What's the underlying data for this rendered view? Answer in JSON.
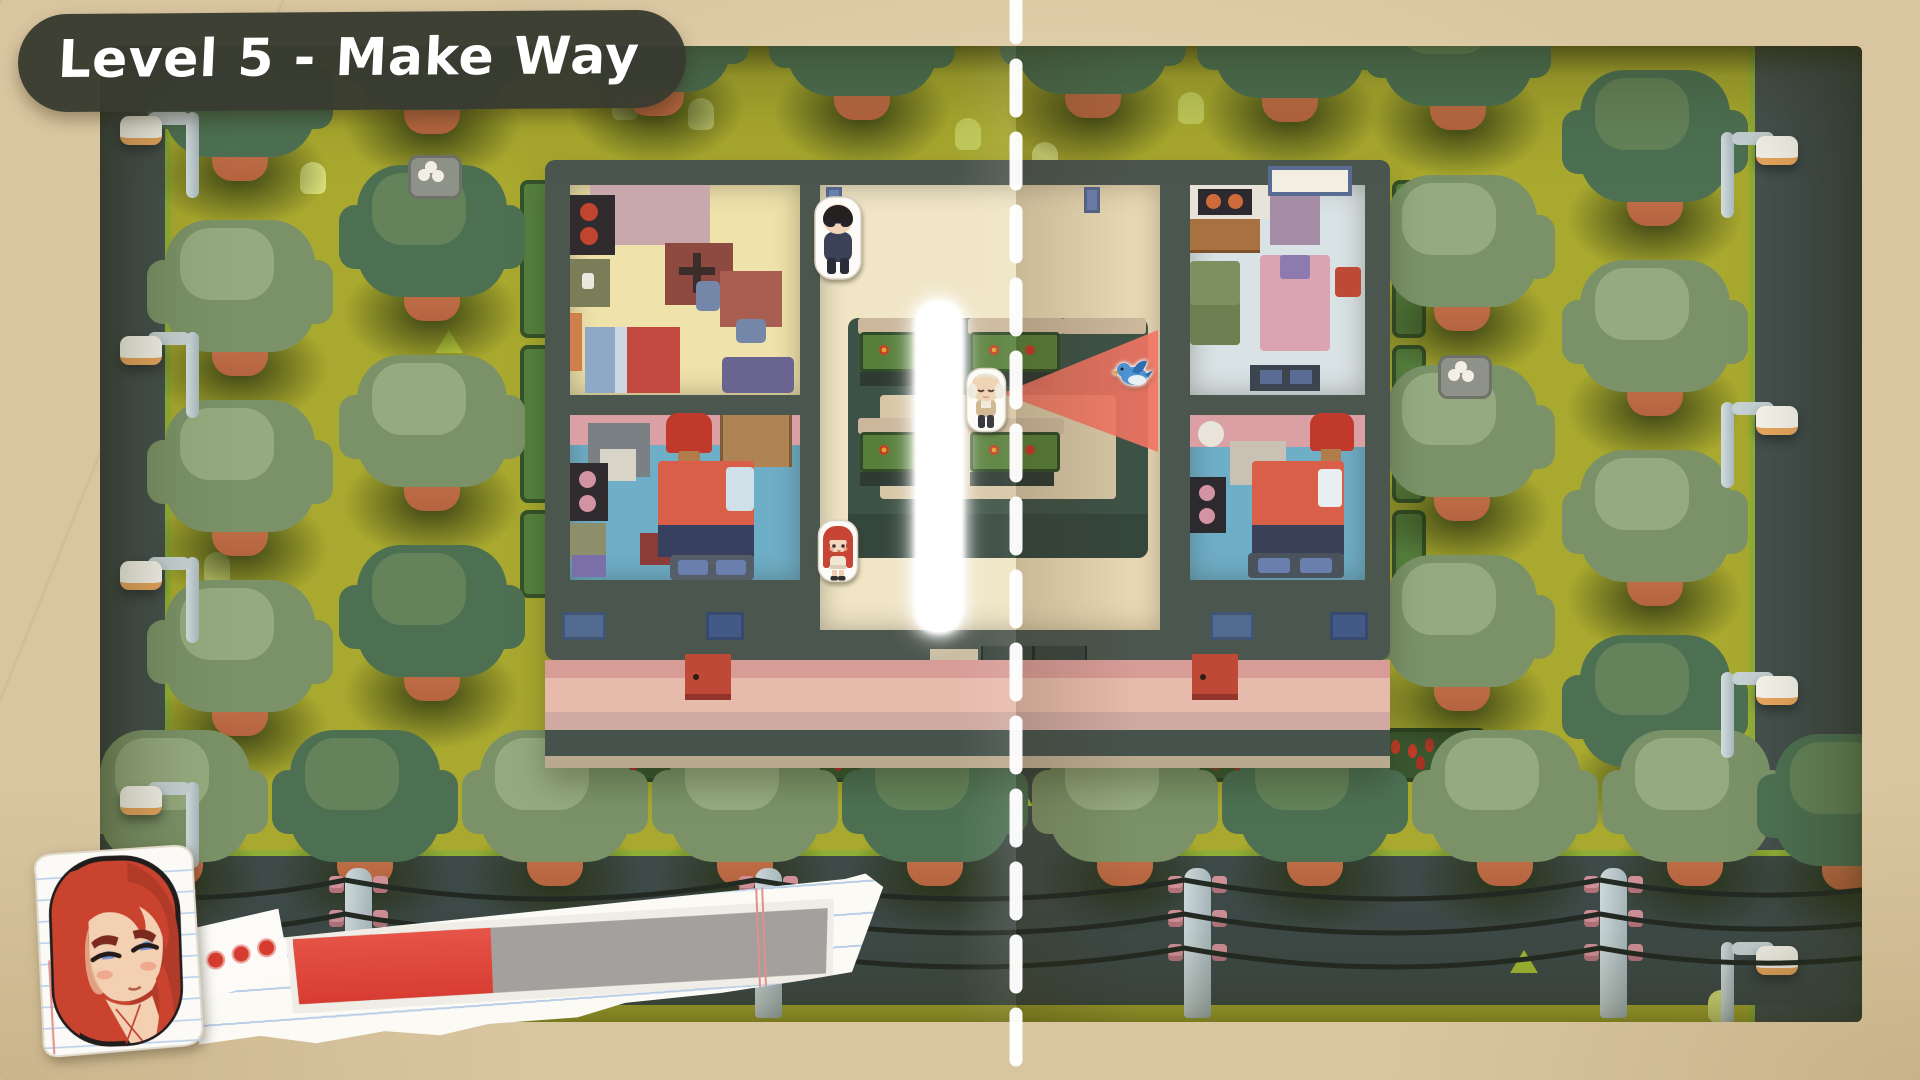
{
  "hud": {
    "level_banner": {
      "label": "Level 5 - Make Way"
    },
    "portrait": {
      "character": "red-haired-girl",
      "style": "notebook-paper-sticker"
    },
    "progress": {
      "percent": 37,
      "fill_color": "#e2463b",
      "track_color": "#a3a09d",
      "pips": 3
    }
  },
  "scene": {
    "fold_line": {
      "x": 1016,
      "color": "#ffffff",
      "style": "dashed-vertical"
    },
    "vision_cone": {
      "owner": "old-man-npc",
      "direction": "right",
      "color": "#f07463"
    },
    "characters": [
      {
        "id": "npc-boy-glasses",
        "x": 712,
        "y": 148
      },
      {
        "id": "npc-old-man",
        "x": 862,
        "y": 316
      },
      {
        "id": "player-red-haired-girl",
        "x": 716,
        "y": 472
      },
      {
        "id": "blue-bird",
        "x": 1012,
        "y": 312
      }
    ],
    "trees": [
      {
        "x": 556,
        "y": -16,
        "v": "dark"
      },
      {
        "x": 762,
        "y": -12,
        "v": "dark"
      },
      {
        "x": 993,
        "y": -14,
        "v": "dark"
      },
      {
        "x": 1190,
        "y": -10,
        "v": "dark"
      },
      {
        "x": 1358,
        "y": -2,
        "v": "dark"
      },
      {
        "x": 140,
        "y": 49,
        "v": "dark"
      },
      {
        "x": 332,
        "y": 2,
        "v": "dark"
      },
      {
        "x": 140,
        "y": 244,
        "v": "sage"
      },
      {
        "x": 140,
        "y": 424,
        "v": "sage"
      },
      {
        "x": 140,
        "y": 604,
        "v": "sage"
      },
      {
        "x": 332,
        "y": 189,
        "v": "dark",
        "nest": true
      },
      {
        "x": 332,
        "y": 379,
        "v": "sage"
      },
      {
        "x": 332,
        "y": 569,
        "v": "dark"
      },
      {
        "x": 1362,
        "y": 199,
        "v": "sage"
      },
      {
        "x": 1362,
        "y": 389,
        "v": "sage",
        "nest": true
      },
      {
        "x": 1362,
        "y": 579,
        "v": "sage"
      },
      {
        "x": 1555,
        "y": 94,
        "v": "dark"
      },
      {
        "x": 1555,
        "y": 284,
        "v": "sage"
      },
      {
        "x": 1555,
        "y": 474,
        "v": "sage"
      },
      {
        "x": 1555,
        "y": 659,
        "v": "dark"
      },
      {
        "x": 75,
        "y": 754,
        "v": "sage"
      },
      {
        "x": 265,
        "y": 754,
        "v": "dark"
      },
      {
        "x": 455,
        "y": 754,
        "v": "sage"
      },
      {
        "x": 645,
        "y": 754,
        "v": "sage",
        "nest": true
      },
      {
        "x": 835,
        "y": 754,
        "v": "dark"
      },
      {
        "x": 1025,
        "y": 754,
        "v": "sage"
      },
      {
        "x": 1215,
        "y": 754,
        "v": "dark"
      },
      {
        "x": 1405,
        "y": 754,
        "v": "sage"
      },
      {
        "x": 1595,
        "y": 754,
        "v": "sage"
      },
      {
        "x": 1750,
        "y": 758,
        "v": "dark"
      }
    ],
    "bushes": [
      {
        "x": 512,
        "y": 42
      },
      {
        "x": 855,
        "y": 72
      },
      {
        "x": 932,
        "y": 96
      },
      {
        "x": 200,
        "y": 116
      },
      {
        "x": 1078,
        "y": 46
      },
      {
        "x": 428,
        "y": 476
      },
      {
        "x": 104,
        "y": 506
      },
      {
        "x": 518,
        "y": 694
      },
      {
        "x": 1012,
        "y": 696
      },
      {
        "x": 588,
        "y": 52
      },
      {
        "x": 1545,
        "y": 687
      },
      {
        "x": 1608,
        "y": 944
      }
    ],
    "tufts": [
      {
        "x": 205,
        "y": 29
      },
      {
        "x": 662,
        "y": 157
      },
      {
        "x": 335,
        "y": 284
      },
      {
        "x": 1107,
        "y": 594
      },
      {
        "x": 1560,
        "y": 687
      },
      {
        "x": 1410,
        "y": 904
      },
      {
        "x": 485,
        "y": 737
      },
      {
        "x": 905,
        "y": 737
      }
    ],
    "lamps": {
      "left_ys": [
        54,
        274,
        499,
        724
      ],
      "right_ys": [
        74,
        344,
        614,
        884
      ]
    },
    "power_poles_x": [
      245,
      655,
      1084,
      1500
    ],
    "flower_beds_x": [
      465,
      670,
      1070,
      1275
    ],
    "hedge_segments": [
      {
        "y": 134,
        "h": 150
      },
      {
        "y": 299,
        "h": 150
      },
      {
        "y": 464,
        "h": 80
      }
    ]
  },
  "palette": {
    "paper": "#d9c6a0",
    "grass": "#a9a92f",
    "road": "#3e4a48",
    "building_wall": "#4b564e",
    "hall_floor": "#f0e5c5",
    "room_cream": "#efe2ab",
    "room_blue": "#6faec7",
    "room_light": "#d9e2e4",
    "roof_pink": "#e7bbac",
    "table_green": "#3d5246",
    "cone": "#f07463",
    "tree_dark": "#4d7053",
    "tree_sage": "#7b9268"
  }
}
